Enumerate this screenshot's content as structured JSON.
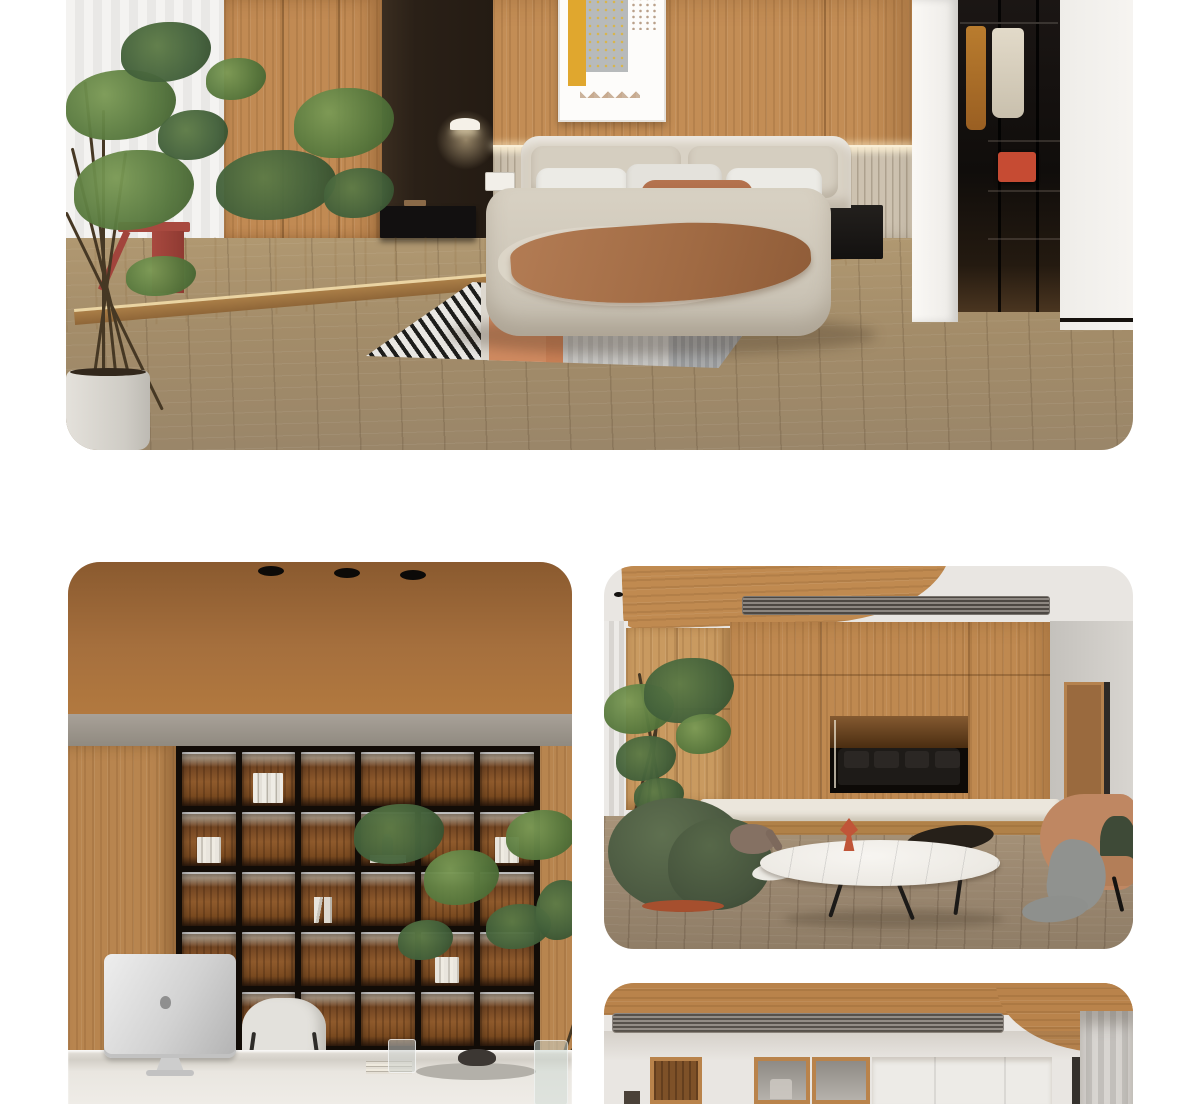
{
  "page": {
    "background": "#ffffff",
    "width": 1200,
    "height": 1104
  },
  "gallery": {
    "hero": {
      "name": "bedroom-render",
      "alt": "Bedroom with oak wardrobe, dark feature wall, beige fabric bed, striped rug and walk-in closet"
    },
    "study": {
      "name": "study-render",
      "alt": "Home office with walnut wood ceiling, backlit bookshelf wall, plant and iMac on white desk"
    },
    "living": {
      "name": "living-render",
      "alt": "Living room with wood TV wall, recessed niche, green armchair, marble coffee table and tan lounge chair"
    },
    "detail": {
      "name": "hallway-render",
      "alt": "Hallway detail with wood ceiling cove, linear AC vent, glass display cabinets and sheer curtains"
    }
  },
  "palette": {
    "oak_wood": "#c08a52",
    "walnut_ceiling": "#a9713d",
    "dark_feature_wall": "#2a2017",
    "floor_wood": "#a18a6b",
    "fluted_panel": "#cdc2b0",
    "bed_beige": "#d3cbbd",
    "pillow_brown": "#ad6c4a",
    "accent_rust_table": "#a8493f",
    "rug_orange": "#d08a60",
    "armchair_green": "#4f5b45",
    "marble_white": "#f2f0ec",
    "closet_dark": "#14100d",
    "bench_white": "#ebe6dc",
    "lounge_tan": "#bf8762",
    "led_light": "#fff7e8"
  },
  "shelf": {
    "rows": 5,
    "cols": 6,
    "items": [
      {
        "row": 1,
        "col": 2,
        "type": "books-tall"
      },
      {
        "row": 2,
        "col": 1,
        "type": "books-pair"
      },
      {
        "row": 2,
        "col": 4,
        "type": "figurine"
      },
      {
        "row": 2,
        "col": 6,
        "type": "books-pair"
      },
      {
        "row": 3,
        "col": 3,
        "type": "books-lean"
      },
      {
        "row": 4,
        "col": 5,
        "type": "books-pair"
      },
      {
        "row": 5,
        "col": 1,
        "type": "books-flat"
      }
    ]
  }
}
